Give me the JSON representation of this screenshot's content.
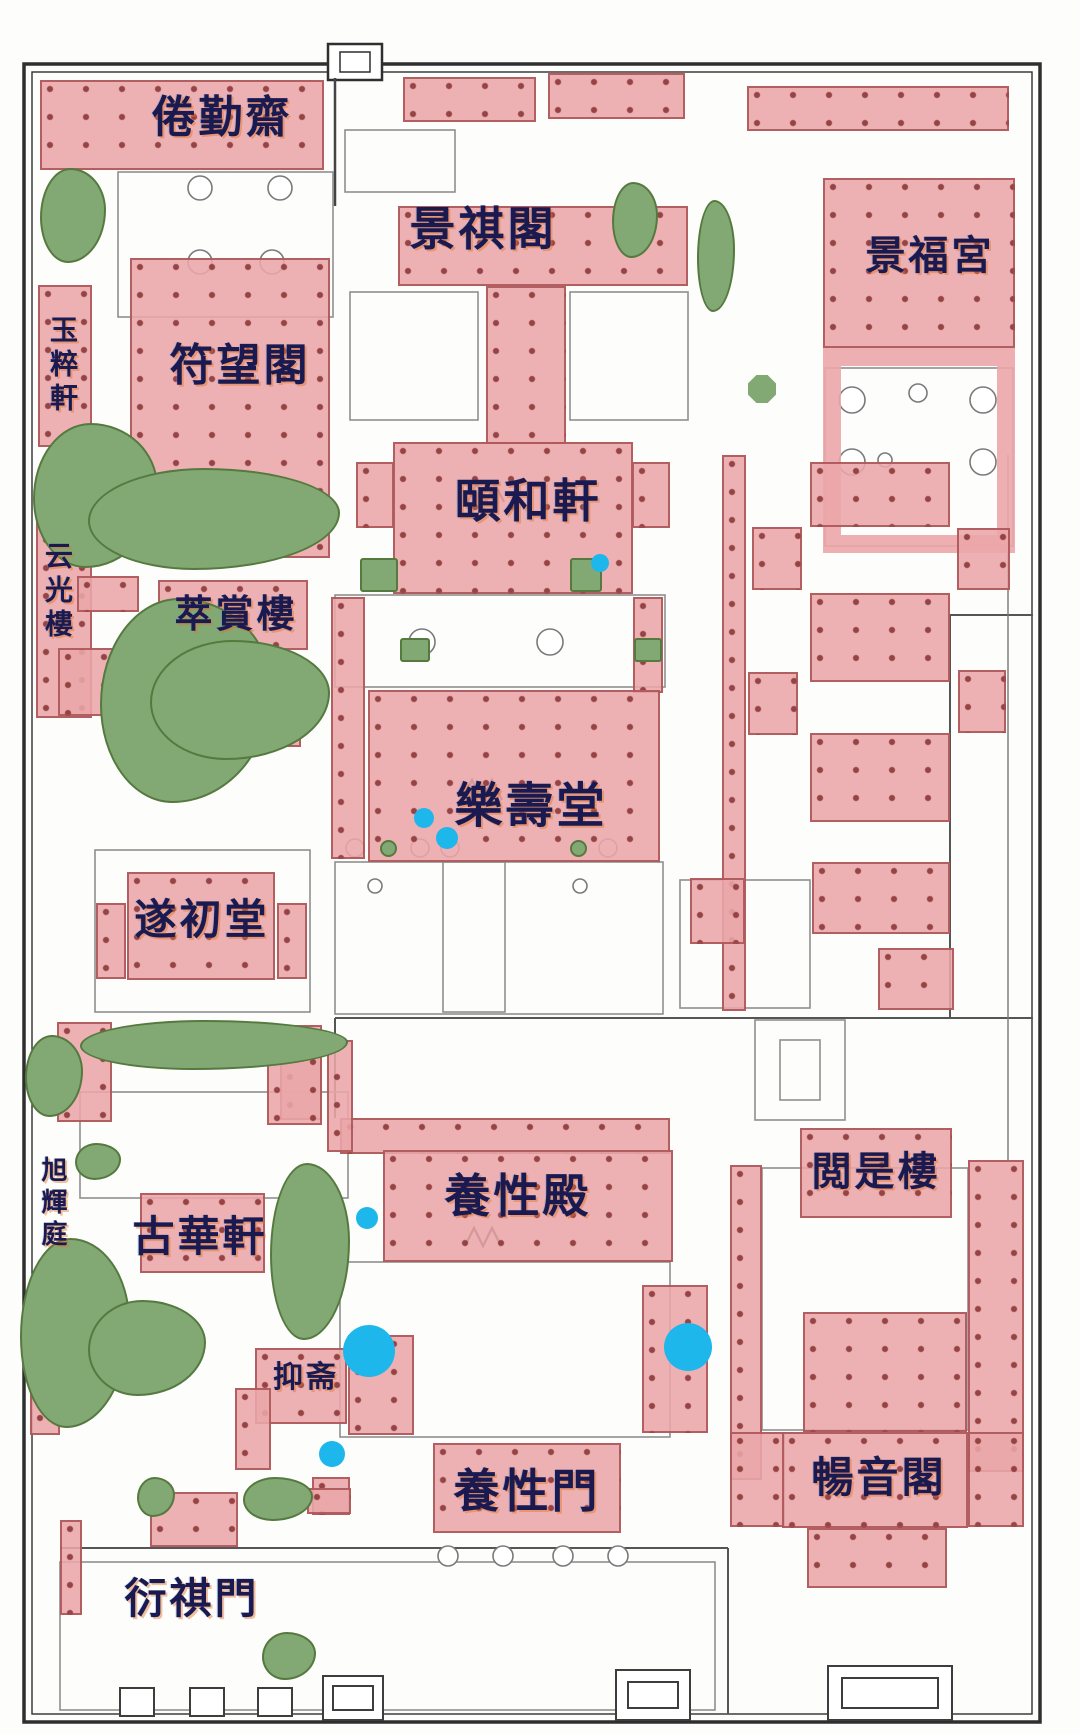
{
  "figure": {
    "kind": "palace-floor-plan",
    "description": "Plan of the Ningshou Palace garden compound with highlighted halls"
  },
  "palette": {
    "highlight_pink": "#ebA6a8",
    "highlight_border": "#a44a4c",
    "column_dot": "#863030",
    "garden_green": "#82a873",
    "garden_edge": "#55793f",
    "marker_blue": "#1db7ec",
    "label_ink": "#1a1a50",
    "label_glow": "#e27428",
    "linework": "#4a4a4a"
  },
  "map": {
    "labels": [
      {
        "id": "label-juanqinzhai",
        "text": "倦勤齋",
        "x": 222,
        "y": 118,
        "size": 44,
        "orientation": "h"
      },
      {
        "id": "label-jingqige",
        "text": "景祺閣",
        "x": 483,
        "y": 229,
        "size": 46,
        "orientation": "h"
      },
      {
        "id": "label-jingfugong",
        "text": "景福宮",
        "x": 930,
        "y": 256,
        "size": 40,
        "orientation": "h"
      },
      {
        "id": "label-fuwangge",
        "text": "符望閣",
        "x": 240,
        "y": 366,
        "size": 44,
        "orientation": "h"
      },
      {
        "id": "label-yucuixuan",
        "text": "玉粹軒",
        "x": 62,
        "y": 366,
        "size": 28,
        "orientation": "v"
      },
      {
        "id": "label-yihexuan",
        "text": "頤和軒",
        "x": 528,
        "y": 501,
        "size": 46,
        "orientation": "h"
      },
      {
        "id": "label-yunguanglou",
        "text": "云光樓",
        "x": 57,
        "y": 592,
        "size": 28,
        "orientation": "v"
      },
      {
        "id": "label-cuishanglou",
        "text": "萃賞樓",
        "x": 236,
        "y": 614,
        "size": 38,
        "orientation": "h"
      },
      {
        "id": "label-leshoutang",
        "text": "樂壽堂",
        "x": 531,
        "y": 806,
        "size": 48,
        "orientation": "h"
      },
      {
        "id": "label-suichutang",
        "text": "遂初堂",
        "x": 202,
        "y": 920,
        "size": 42,
        "orientation": "h"
      },
      {
        "id": "label-xuhuiting",
        "text": "旭輝庭",
        "x": 52,
        "y": 1204,
        "size": 26,
        "orientation": "v"
      },
      {
        "id": "label-guhuaxuan",
        "text": "古華軒",
        "x": 200,
        "y": 1237,
        "size": 42,
        "orientation": "h"
      },
      {
        "id": "label-yangxingdian",
        "text": "養性殿",
        "x": 518,
        "y": 1196,
        "size": 46,
        "orientation": "h"
      },
      {
        "id": "label-yueshilou",
        "text": "閲是樓",
        "x": 876,
        "y": 1172,
        "size": 40,
        "orientation": "h"
      },
      {
        "id": "label-yizhai",
        "text": "抑斋",
        "x": 306,
        "y": 1378,
        "size": 30,
        "orientation": "h"
      },
      {
        "id": "label-yangxingmen",
        "text": "養性門",
        "x": 527,
        "y": 1491,
        "size": 46,
        "orientation": "h"
      },
      {
        "id": "label-changyinge",
        "text": "暢音閣",
        "x": 879,
        "y": 1478,
        "size": 42,
        "orientation": "h"
      },
      {
        "id": "label-yanqimen",
        "text": "衍祺門",
        "x": 192,
        "y": 1599,
        "size": 42,
        "orientation": "h"
      }
    ],
    "buildings": [
      {
        "id": "bld-juanqinzhai",
        "x": 40,
        "y": 80,
        "w": 284,
        "h": 90
      },
      {
        "id": "bld-top-band-a",
        "x": 403,
        "y": 77,
        "w": 133,
        "h": 45
      },
      {
        "id": "bld-top-band-b",
        "x": 548,
        "y": 73,
        "w": 137,
        "h": 46
      },
      {
        "id": "bld-top-band-right",
        "x": 747,
        "y": 86,
        "w": 262,
        "h": 45
      },
      {
        "id": "bld-jingqige",
        "x": 398,
        "y": 206,
        "w": 290,
        "h": 80
      },
      {
        "id": "bld-jingqige-neck",
        "x": 486,
        "y": 286,
        "w": 80,
        "h": 158
      },
      {
        "id": "bld-jingfugong",
        "x": 823,
        "y": 178,
        "w": 192,
        "h": 170
      },
      {
        "id": "bld-jingfugong-court",
        "x": 823,
        "y": 348,
        "w": 192,
        "h": 205,
        "frame": true
      },
      {
        "id": "bld-fuwangge",
        "x": 130,
        "y": 258,
        "w": 200,
        "h": 300
      },
      {
        "id": "bld-yucuixuan",
        "x": 38,
        "y": 285,
        "w": 54,
        "h": 162
      },
      {
        "id": "bld-yunguanglou",
        "x": 36,
        "y": 503,
        "w": 56,
        "h": 215
      },
      {
        "id": "bld-yunguang-annex",
        "x": 58,
        "y": 648,
        "w": 72,
        "h": 68
      },
      {
        "id": "bld-cuishang-annex",
        "x": 77,
        "y": 576,
        "w": 62,
        "h": 36
      },
      {
        "id": "bld-cuishanglou",
        "x": 158,
        "y": 580,
        "w": 150,
        "h": 70
      },
      {
        "id": "bld-rockery-pavilion",
        "x": 243,
        "y": 692,
        "w": 58,
        "h": 55
      },
      {
        "id": "bld-yihexuan",
        "x": 393,
        "y": 442,
        "w": 240,
        "h": 152
      },
      {
        "id": "bld-yihe-west-wing",
        "x": 356,
        "y": 462,
        "w": 38,
        "h": 66
      },
      {
        "id": "bld-yihe-east-wing",
        "x": 632,
        "y": 462,
        "w": 38,
        "h": 66
      },
      {
        "id": "bld-west-corridor",
        "x": 331,
        "y": 597,
        "w": 34,
        "h": 262
      },
      {
        "id": "bld-east-corridor",
        "x": 633,
        "y": 597,
        "w": 30,
        "h": 96
      },
      {
        "id": "bld-leshoutang",
        "x": 368,
        "y": 690,
        "w": 292,
        "h": 172
      },
      {
        "id": "bld-suichutang",
        "x": 127,
        "y": 872,
        "w": 148,
        "h": 108
      },
      {
        "id": "bld-suichu-west",
        "x": 96,
        "y": 903,
        "w": 30,
        "h": 76
      },
      {
        "id": "bld-suichu-east",
        "x": 277,
        "y": 903,
        "w": 30,
        "h": 76
      },
      {
        "id": "bld-east-gallery",
        "x": 722,
        "y": 455,
        "w": 24,
        "h": 556
      },
      {
        "id": "bld-east-hall-1",
        "x": 810,
        "y": 462,
        "w": 140,
        "h": 65
      },
      {
        "id": "bld-east-hall-2",
        "x": 810,
        "y": 593,
        "w": 140,
        "h": 89
      },
      {
        "id": "bld-east-hall-3",
        "x": 810,
        "y": 733,
        "w": 140,
        "h": 89
      },
      {
        "id": "bld-east-side-1",
        "x": 752,
        "y": 527,
        "w": 50,
        "h": 63
      },
      {
        "id": "bld-east-side-2",
        "x": 957,
        "y": 528,
        "w": 53,
        "h": 62
      },
      {
        "id": "bld-east-side-3",
        "x": 748,
        "y": 672,
        "w": 50,
        "h": 63
      },
      {
        "id": "bld-east-side-4",
        "x": 958,
        "y": 670,
        "w": 48,
        "h": 63
      },
      {
        "id": "bld-east-hall-4",
        "x": 812,
        "y": 862,
        "w": 138,
        "h": 72
      },
      {
        "id": "bld-east-side-5",
        "x": 690,
        "y": 878,
        "w": 55,
        "h": 66
      },
      {
        "id": "bld-east-side-6",
        "x": 878,
        "y": 948,
        "w": 76,
        "h": 62
      },
      {
        "id": "bld-yangxing-band",
        "x": 340,
        "y": 1118,
        "w": 330,
        "h": 36
      },
      {
        "id": "bld-yangxingdian",
        "x": 383,
        "y": 1150,
        "w": 290,
        "h": 112
      },
      {
        "id": "bld-nw-corridor",
        "x": 327,
        "y": 1040,
        "w": 26,
        "h": 112
      },
      {
        "id": "bld-sw-block",
        "x": 280,
        "y": 1040,
        "w": 42,
        "h": 80
      },
      {
        "id": "bld-guhua-east-flank",
        "x": 267,
        "y": 1025,
        "w": 55,
        "h": 100
      },
      {
        "id": "bld-guhua-west-flank",
        "x": 57,
        "y": 1022,
        "w": 55,
        "h": 100
      },
      {
        "id": "bld-yueshilou",
        "x": 800,
        "y": 1128,
        "w": 152,
        "h": 90
      },
      {
        "id": "bld-theater-frame-west",
        "x": 730,
        "y": 1165,
        "w": 32,
        "h": 315
      },
      {
        "id": "bld-theater-frame-east",
        "x": 968,
        "y": 1160,
        "w": 56,
        "h": 312
      },
      {
        "id": "bld-theater-frame-west2",
        "x": 730,
        "y": 1432,
        "w": 55,
        "h": 95
      },
      {
        "id": "bld-theater-frame-east2",
        "x": 968,
        "y": 1432,
        "w": 56,
        "h": 95
      },
      {
        "id": "bld-changyinge-tower",
        "x": 803,
        "y": 1312,
        "w": 164,
        "h": 120
      },
      {
        "id": "bld-changyinge",
        "x": 782,
        "y": 1432,
        "w": 186,
        "h": 96
      },
      {
        "id": "bld-changyin-south",
        "x": 807,
        "y": 1528,
        "w": 140,
        "h": 60
      },
      {
        "id": "bld-mid-south-block",
        "x": 642,
        "y": 1285,
        "w": 66,
        "h": 148
      },
      {
        "id": "bld-yizhai",
        "x": 255,
        "y": 1348,
        "w": 92,
        "h": 76
      },
      {
        "id": "bld-yizhai-east",
        "x": 348,
        "y": 1335,
        "w": 66,
        "h": 100
      },
      {
        "id": "bld-yizhai-square",
        "x": 312,
        "y": 1477,
        "w": 38,
        "h": 38
      },
      {
        "id": "bld-yizhai-west",
        "x": 235,
        "y": 1388,
        "w": 36,
        "h": 82
      },
      {
        "id": "bld-garden-pavilion",
        "x": 293,
        "y": 1255,
        "w": 32,
        "h": 40
      },
      {
        "id": "bld-yangxingmen",
        "x": 433,
        "y": 1443,
        "w": 188,
        "h": 90
      },
      {
        "id": "bld-yanqi-block",
        "x": 150,
        "y": 1492,
        "w": 88,
        "h": 55
      },
      {
        "id": "bld-small-south",
        "x": 307,
        "y": 1488,
        "w": 44,
        "h": 26
      },
      {
        "id": "bld-guhuaxuan",
        "x": 140,
        "y": 1193,
        "w": 125,
        "h": 80
      },
      {
        "id": "bld-west-strip-1",
        "x": 30,
        "y": 1325,
        "w": 30,
        "h": 110
      },
      {
        "id": "bld-west-strip-2",
        "x": 60,
        "y": 1520,
        "w": 22,
        "h": 95
      }
    ],
    "gardens": [
      {
        "id": "garden-nw-corner",
        "x": 40,
        "y": 168,
        "w": 66,
        "h": 95,
        "shape": "blob"
      },
      {
        "id": "garden-top-center",
        "x": 612,
        "y": 182,
        "w": 46,
        "h": 76,
        "shape": "blob"
      },
      {
        "id": "garden-top-right",
        "x": 697,
        "y": 200,
        "w": 38,
        "h": 112,
        "shape": "blob"
      },
      {
        "id": "garden-octagon",
        "x": 748,
        "y": 375,
        "w": 28,
        "h": 28,
        "shape": "octagon"
      },
      {
        "id": "garden-snake-a",
        "x": 33,
        "y": 423,
        "w": 125,
        "h": 145,
        "shape": "blob"
      },
      {
        "id": "garden-snake-b",
        "x": 88,
        "y": 468,
        "w": 252,
        "h": 102,
        "shape": "blob"
      },
      {
        "id": "garden-rockery-a",
        "x": 100,
        "y": 598,
        "w": 172,
        "h": 205,
        "shape": "blob"
      },
      {
        "id": "garden-rockery-b",
        "x": 150,
        "y": 640,
        "w": 180,
        "h": 120,
        "shape": "blob"
      },
      {
        "id": "garden-court-w",
        "x": 360,
        "y": 558,
        "w": 38,
        "h": 34,
        "shape": "rect"
      },
      {
        "id": "garden-court-e",
        "x": 570,
        "y": 558,
        "w": 32,
        "h": 34,
        "shape": "rect"
      },
      {
        "id": "garden-leshou-w",
        "x": 400,
        "y": 638,
        "w": 30,
        "h": 24,
        "shape": "rect"
      },
      {
        "id": "garden-leshou-e",
        "x": 634,
        "y": 638,
        "w": 28,
        "h": 24,
        "shape": "rect"
      },
      {
        "id": "garden-dot-w",
        "x": 380,
        "y": 840,
        "w": 17,
        "h": 17,
        "shape": "dot"
      },
      {
        "id": "garden-dot-e",
        "x": 570,
        "y": 840,
        "w": 17,
        "h": 17,
        "shape": "dot"
      },
      {
        "id": "garden-guhua-band",
        "x": 80,
        "y": 1020,
        "w": 268,
        "h": 50,
        "shape": "blob"
      },
      {
        "id": "garden-guhua-west",
        "x": 25,
        "y": 1035,
        "w": 58,
        "h": 82,
        "shape": "blob"
      },
      {
        "id": "garden-mid-strip",
        "x": 270,
        "y": 1163,
        "w": 80,
        "h": 177,
        "shape": "blob"
      },
      {
        "id": "garden-sw-mass-a",
        "x": 20,
        "y": 1238,
        "w": 110,
        "h": 190,
        "shape": "blob"
      },
      {
        "id": "garden-sw-mass-b",
        "x": 88,
        "y": 1300,
        "w": 118,
        "h": 96,
        "shape": "blob"
      },
      {
        "id": "garden-small-1",
        "x": 137,
        "y": 1477,
        "w": 38,
        "h": 40,
        "shape": "blob"
      },
      {
        "id": "garden-small-2",
        "x": 243,
        "y": 1477,
        "w": 70,
        "h": 44,
        "shape": "blob"
      },
      {
        "id": "garden-tree",
        "x": 262,
        "y": 1632,
        "w": 54,
        "h": 48,
        "shape": "blob"
      },
      {
        "id": "garden-small-3",
        "x": 75,
        "y": 1143,
        "w": 46,
        "h": 37,
        "shape": "blob"
      }
    ],
    "markers": [
      {
        "id": "marker-yihexuan",
        "x": 600,
        "y": 563,
        "r": 9
      },
      {
        "id": "marker-leshou-1",
        "x": 424,
        "y": 818,
        "r": 10
      },
      {
        "id": "marker-leshou-2",
        "x": 447,
        "y": 838,
        "r": 11
      },
      {
        "id": "marker-yangxing-west",
        "x": 367,
        "y": 1218,
        "r": 11
      },
      {
        "id": "marker-yizhai-large",
        "x": 369,
        "y": 1351,
        "r": 26
      },
      {
        "id": "marker-east-large",
        "x": 688,
        "y": 1347,
        "r": 24
      },
      {
        "id": "marker-yizhai-small",
        "x": 332,
        "y": 1454,
        "r": 13
      }
    ]
  }
}
